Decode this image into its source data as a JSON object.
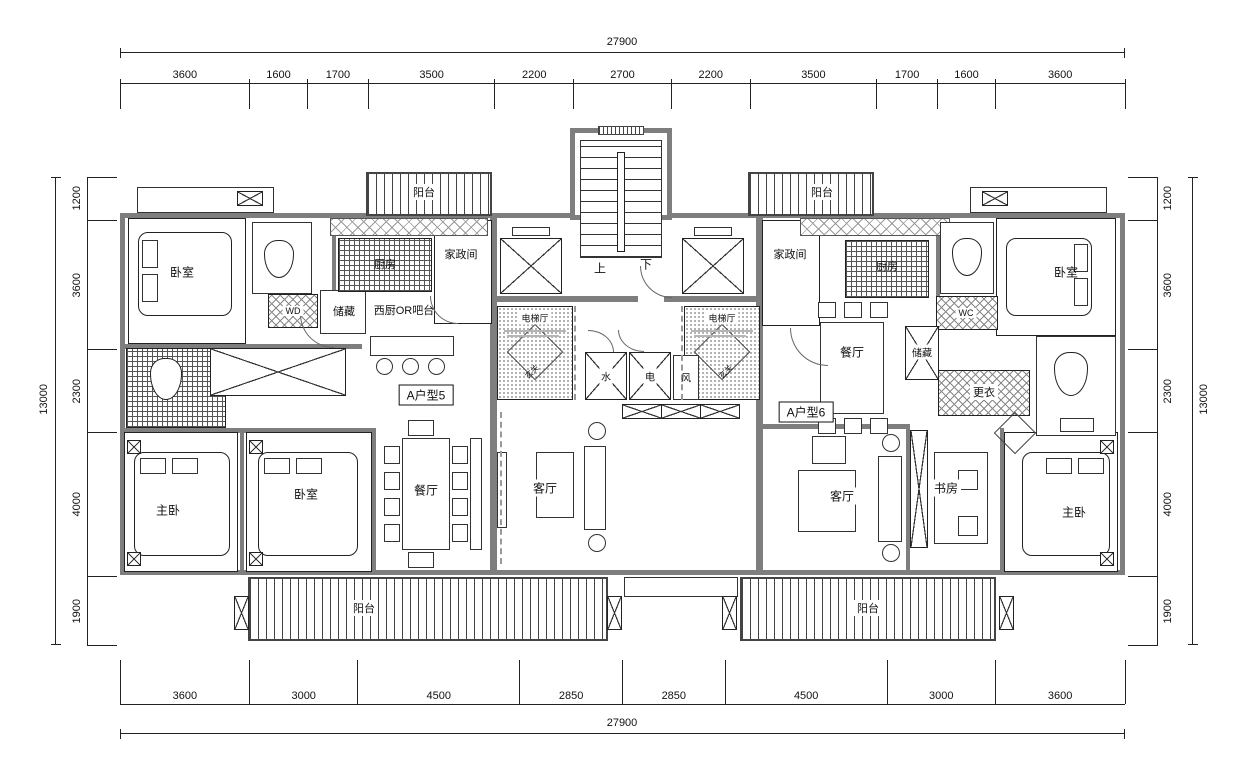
{
  "dimensions": {
    "top": {
      "total": "27900",
      "segments": [
        "3600",
        "1600",
        "1700",
        "3500",
        "2200",
        "2700",
        "2200",
        "3500",
        "1700",
        "1600",
        "3600"
      ]
    },
    "bottom": {
      "total": "27900",
      "segments": [
        "3600",
        "3000",
        "4500",
        "2850",
        "2850",
        "4500",
        "3000",
        "3600"
      ]
    },
    "left": {
      "total": "13000",
      "segments": [
        "1200",
        "3600",
        "2300",
        "4000",
        "1900"
      ]
    },
    "right": {
      "total": "13000",
      "segments": [
        "1200",
        "3600",
        "2300",
        "4000",
        "1900"
      ]
    }
  },
  "core": {
    "up": "上",
    "down": "下",
    "elevator_hall": "电梯厅",
    "foyer": "玄关",
    "shaft_water": "水",
    "shaft_power": "电",
    "shaft_vent": "风"
  },
  "unit_left": {
    "unit_label": "A户型5",
    "bedroom_top": "卧室",
    "bedroom_bottom": "卧室",
    "master_bedroom": "主卧",
    "dining": "餐厅",
    "living": "客厅",
    "kitchen": "厨房",
    "west_kitchen": "西厨OR吧台",
    "housekeeping": "家政间",
    "storage": "储藏",
    "wd": "WD",
    "balcony_top": "阳台",
    "balcony_bottom": "阳台"
  },
  "unit_right": {
    "unit_label": "A户型6",
    "bedroom_top": "卧室",
    "master_bedroom": "主卧",
    "dining": "餐厅",
    "living": "客厅",
    "study": "书房",
    "kitchen": "厨房",
    "housekeeping": "家政间",
    "storage": "储藏",
    "dressing": "更衣",
    "wc": "WC",
    "balcony_top": "阳台",
    "balcony_bottom": "阳台"
  }
}
